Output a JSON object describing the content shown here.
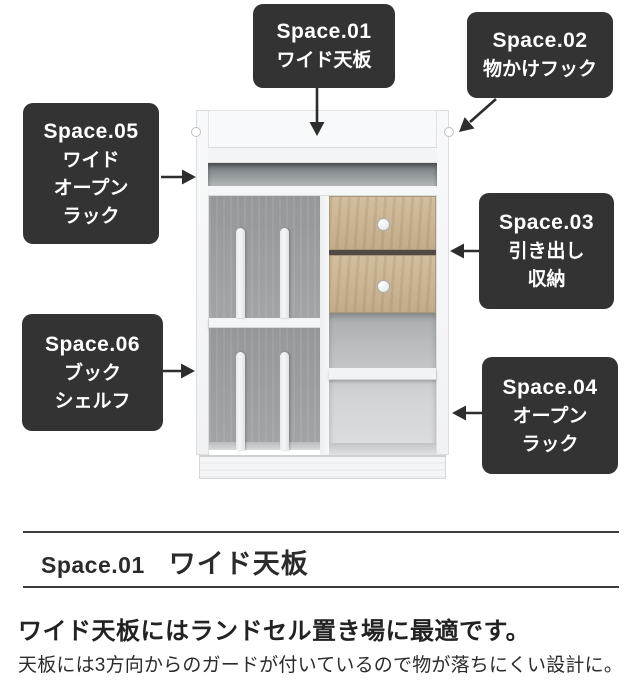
{
  "callouts": [
    {
      "title": "Space.01",
      "lines": [
        "ワイド天板"
      ]
    },
    {
      "title": "Space.02",
      "lines": [
        "物かけフック"
      ]
    },
    {
      "title": "Space.03",
      "lines": [
        "引き出し",
        "収納"
      ]
    },
    {
      "title": "Space.04",
      "lines": [
        "オープン",
        "ラック"
      ]
    },
    {
      "title": "Space.05",
      "lines": [
        "ワイド",
        "オープン",
        "ラック"
      ]
    },
    {
      "title": "Space.06",
      "lines": [
        "ブック",
        "シェルフ"
      ]
    }
  ],
  "section": {
    "number": "Space.01",
    "title": "ワイド天板",
    "lead": "ワイド天板にはランドセル置き場に最適です。",
    "body": "天板には3方向からのガードが付いているので物が落ちにくい設計に。"
  },
  "colors": {
    "label_background": "#333333",
    "label_text": "#ffffff",
    "arrow": "#2d2d2d",
    "rule": "#3c3c3c",
    "cabinet_white": "#f6f7f8",
    "interior_gray": "#9b9ea1",
    "drawer_wood": "#c8b294"
  }
}
